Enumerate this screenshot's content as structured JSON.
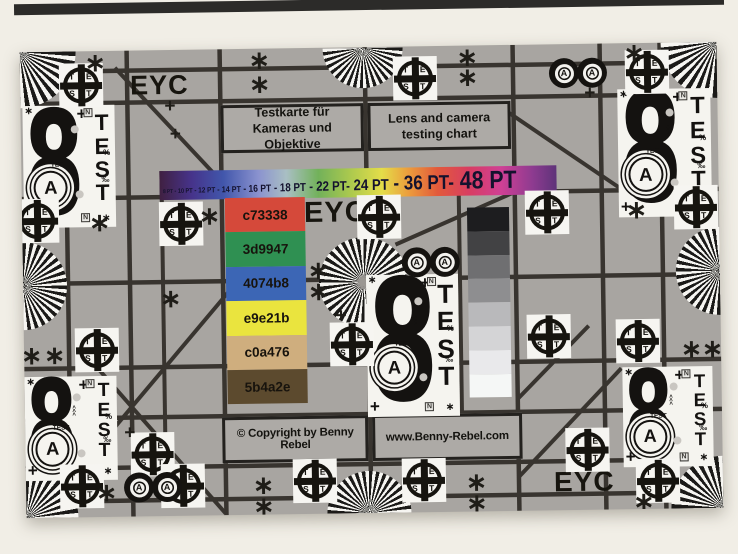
{
  "photo": {
    "background": "#f1eee6",
    "top_strip_color": "#2c2b29"
  },
  "card": {
    "background": "#a8a5a1",
    "line_color": "#38342f",
    "panel_white": "#f5f4ef",
    "ink": "#17150f"
  },
  "titles": {
    "german_line1": "Testkarte für",
    "german_line2": "Kameras und Objektive",
    "english_line1": "Lens and camera",
    "english_line2": "testing chart"
  },
  "branding": {
    "eyc": "EYC",
    "copyright": "© Copyright by Benny Rebel",
    "website": "www.Benny-Rebel.com"
  },
  "rainbow": {
    "pt_labels": [
      {
        "text": "8 PT",
        "size": 5.5
      },
      {
        "text": " - 10 PT",
        "size": 6.5
      },
      {
        "text": " - 12 PT",
        "size": 7.5
      },
      {
        "text": " - 14 PT",
        "size": 8.5
      },
      {
        "text": " - 16 PT",
        "size": 10
      },
      {
        "text": " - 18 PT",
        "size": 11.5
      },
      {
        "text": " - 22 PT-",
        "size": 13.5
      },
      {
        "text": " 24 PT",
        "size": 15.5
      },
      {
        "text": " - 36 PT-",
        "size": 20
      },
      {
        "text": " 48 PT",
        "size": 25
      }
    ],
    "gradient_stops": [
      [
        "#402041",
        0
      ],
      [
        "#46338a",
        8
      ],
      [
        "#4156ab",
        16
      ],
      [
        "#8b93cf",
        25
      ],
      [
        "#a9bfc3",
        32
      ],
      [
        "#72b15a",
        40
      ],
      [
        "#abc94e",
        48
      ],
      [
        "#e4dd49",
        56
      ],
      [
        "#ec9a3c",
        63
      ],
      [
        "#e25a3b",
        70
      ],
      [
        "#d83d62",
        78
      ],
      [
        "#d04095",
        86
      ],
      [
        "#8d3b90",
        94
      ],
      [
        "#5e3379",
        100
      ]
    ]
  },
  "swatches": [
    {
      "label": "c73338",
      "fill": "#d5493a"
    },
    {
      "label": "3d9947",
      "fill": "#2f9052"
    },
    {
      "label": "4074b8",
      "fill": "#3c66b5"
    },
    {
      "label": "e9e21b",
      "fill": "#eae43e"
    },
    {
      "label": "c0a476",
      "fill": "#cfae7e"
    },
    {
      "label": "5b4a2e",
      "fill": "#5c4a2e"
    }
  ],
  "grayscale_steps": [
    "#1d1d1f",
    "#424244",
    "#6f6f71",
    "#8e8e90",
    "#b9b9bb",
    "#d4d4d6",
    "#e9e9eb",
    "#f5f7f6"
  ],
  "targets": {
    "crosshair_letters": [
      "T",
      "E",
      "S",
      "T"
    ],
    "big8": {
      "digit": "8",
      "circled_letter": "A",
      "vertical_label": "TEST",
      "mini_label": "TEST"
    },
    "h8_letter": "A",
    "asterisk_glyph": "∗",
    "plus_glyph": "+",
    "percent_glyph": "%",
    "permille_glyph": "‰",
    "arrows_glyph": "<<<",
    "n_glyph": "N"
  }
}
